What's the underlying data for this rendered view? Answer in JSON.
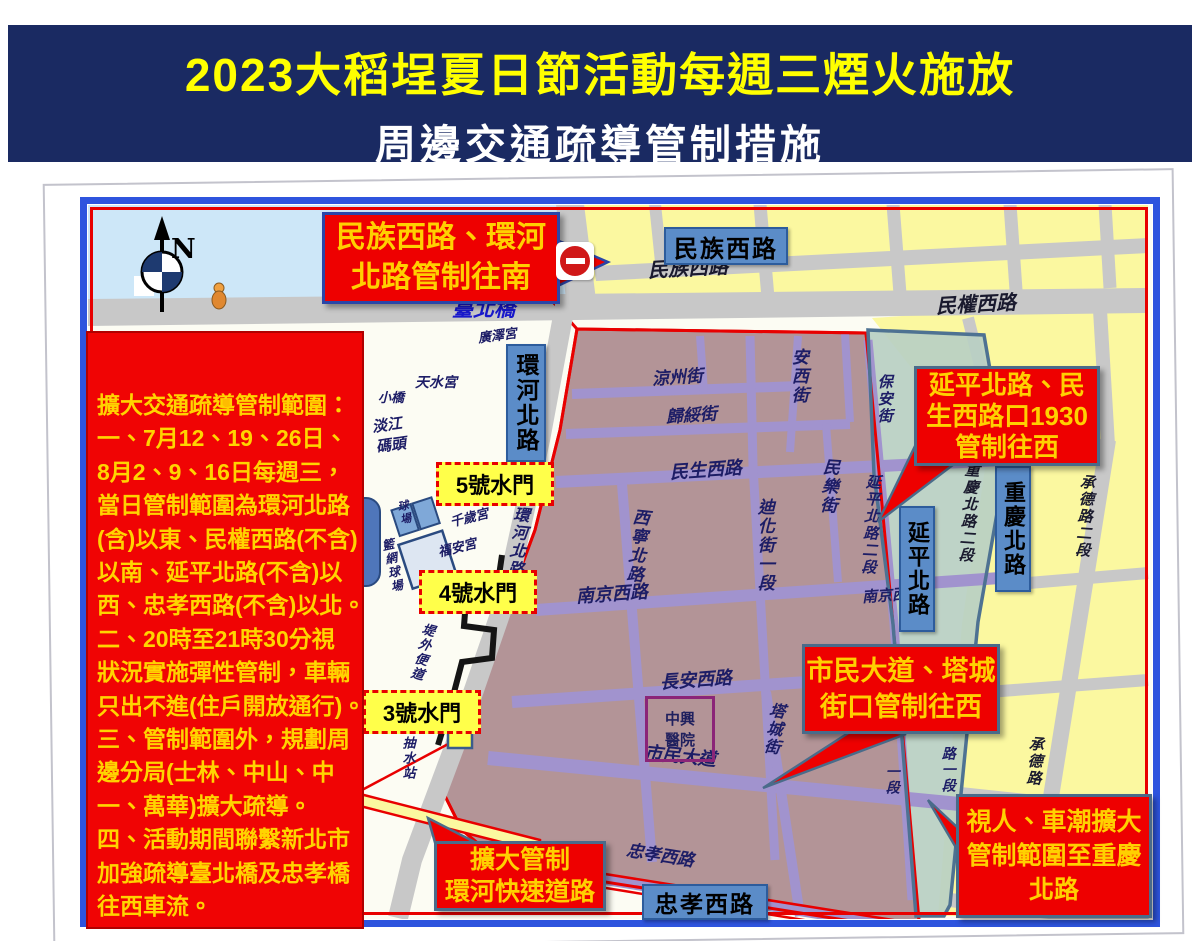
{
  "header": {
    "title_line1": "2023大稻埕夏日節活動每週三煙火施放",
    "title_line2": "周邊交通疏導管制措施"
  },
  "info_box": {
    "lines": [
      "擴大交通疏導管制範圍：",
      "一、7月12、19、26日、",
      "8月2、9、16日每週三，",
      "當日管制範圍為環河北路",
      "(含)以東、民權西路(不含)",
      "以南、延平北路(不含)以",
      "西、忠孝西路(不含)以北。",
      "二、20時至21時30分視",
      "狀況實施彈性管制，車輛",
      "只出不進(住戶開放通行)。",
      "三、管制範圍外，規劃周",
      "邊分局(士林、中山、中",
      "一、萬華)擴大疏導。",
      "四、活動期間聯繫新北市",
      "加強疏導臺北橋及忠孝橋",
      "往西車流。"
    ]
  },
  "callouts": {
    "north": {
      "line1": "民族西路、環河",
      "line2": "北路管制往南"
    },
    "yanping": {
      "line1": "延平北路、民",
      "line2": "生西路口1930",
      "line3": "管制往西"
    },
    "shimin": {
      "line1": "市民大道、塔城",
      "line2": "街口管制往西"
    },
    "chongqing": {
      "line1": "視人、車潮擴大",
      "line2": "管制範圍至重慶",
      "line3": "北路"
    },
    "huanhe": {
      "line1": "擴大管制",
      "line2": "環河快速道路"
    }
  },
  "street_boxes": {
    "minzu": "民族西路",
    "huanhe": "環河北路",
    "yanping": "延平北路",
    "chongqing": "重慶北路",
    "zhongxiao": "忠孝西路"
  },
  "water_gates": {
    "g5": "5號水門",
    "g4": "4號水門",
    "g3": "3號水門"
  },
  "hospital": {
    "line1": "中興",
    "line2": "醫院"
  },
  "compass": {
    "n": "N"
  },
  "map_labels": {
    "minzu_st": "民族西路",
    "minquan_st": "民權西路",
    "taipei_bridge": "臺北橋",
    "guangze": "廣澤宮",
    "tianshui": "天水宮",
    "xiaoqiao": "小橋",
    "danjiang": "淡江",
    "matou": "碼頭",
    "qiansui": "千歲宮",
    "fuan": "福安宮",
    "courts": "球場",
    "tennis": "籃網球場",
    "dike": "堤外便道",
    "pump": "抽水站",
    "huanhe_s": "環河北路",
    "liangzhou": "涼州街",
    "anxi": "安西街",
    "guisui": "歸綏街",
    "minsheng": "民生西路",
    "minle": "民樂街",
    "dihua": "迪化街一段",
    "xining": "西寧北路",
    "nanjing": "南京西路",
    "nanjing_e": "南京西路",
    "changan": "長安西路",
    "tacheng": "塔城街",
    "shimin": "市民大道",
    "zhongxiao_st": "忠孝西路",
    "yanping2": "延平北路二段",
    "chongqing2": "重慶北路二段",
    "chengde2": "承德路二段",
    "chengde": "承德路",
    "baoan": "保安街",
    "lu_yi_duan": "路一段",
    "yi_duan": "一段"
  },
  "colors": {
    "header_bg": "#1a2a62",
    "title_yellow": "#ffff00",
    "control_zone_mauve": "#b39497",
    "extended_zone_green": "#b8cfc3",
    "outside_yellow": "#fbf8a0",
    "road_gray": "#c8c8c8",
    "purple_road": "#a193ce",
    "water_blue": "#cde7f8",
    "frame_blue": "#2e54de",
    "control_red": "#e80000",
    "callout_red": "#ee0000",
    "callout_text": "#ffd000",
    "label_box_blue": "#5b8cc8"
  }
}
